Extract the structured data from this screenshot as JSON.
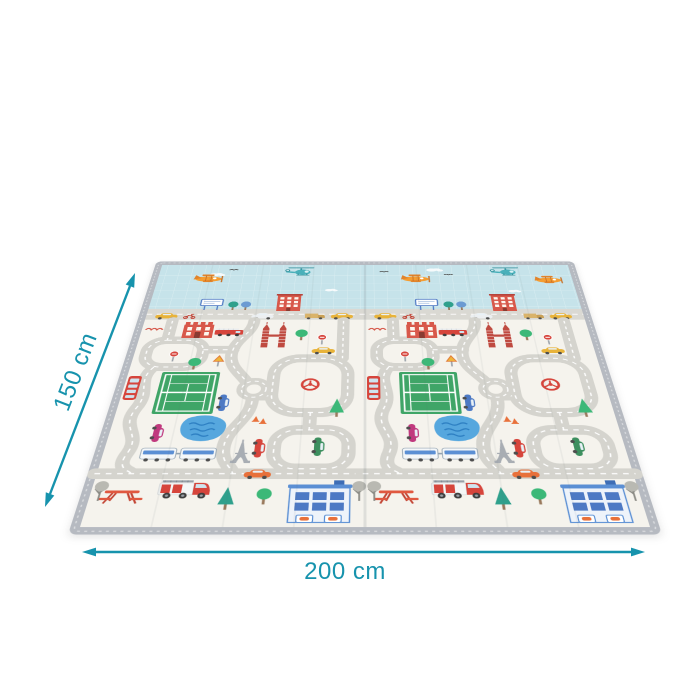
{
  "dimensions": {
    "width_label": "200 cm",
    "height_label": "150 cm"
  },
  "colors": {
    "accent": "#1793ad",
    "sky": "#c6e3ea",
    "mat_base": "#f5f3ed",
    "road": "#d5d4ce",
    "road_dash": "#ffffff",
    "border": "#b6bac1",
    "court_green": "#3fa567",
    "pond_blue": "#56a7de",
    "vehicle_red": "#d6453c",
    "plane_orange": "#f59d31"
  },
  "illustration_icons": [
    "airplane-icon",
    "helicopter-icon",
    "cloud-icon",
    "bird-icon",
    "road-network",
    "roundabout",
    "tennis-court",
    "pond",
    "twin-towers-icon",
    "eiffel-tower-icon",
    "train-icon",
    "fire-truck-icon",
    "ladder-truck-icon",
    "bus-icon",
    "car-icon",
    "taxi-icon",
    "scooter-icon",
    "billboard-icon",
    "castle-building-icon",
    "tall-building-icon",
    "office-building-icon",
    "picnic-table-icon",
    "tree-icon",
    "traffic-sign-icon",
    "traffic-cone-icon",
    "steering-wheel-icon"
  ]
}
